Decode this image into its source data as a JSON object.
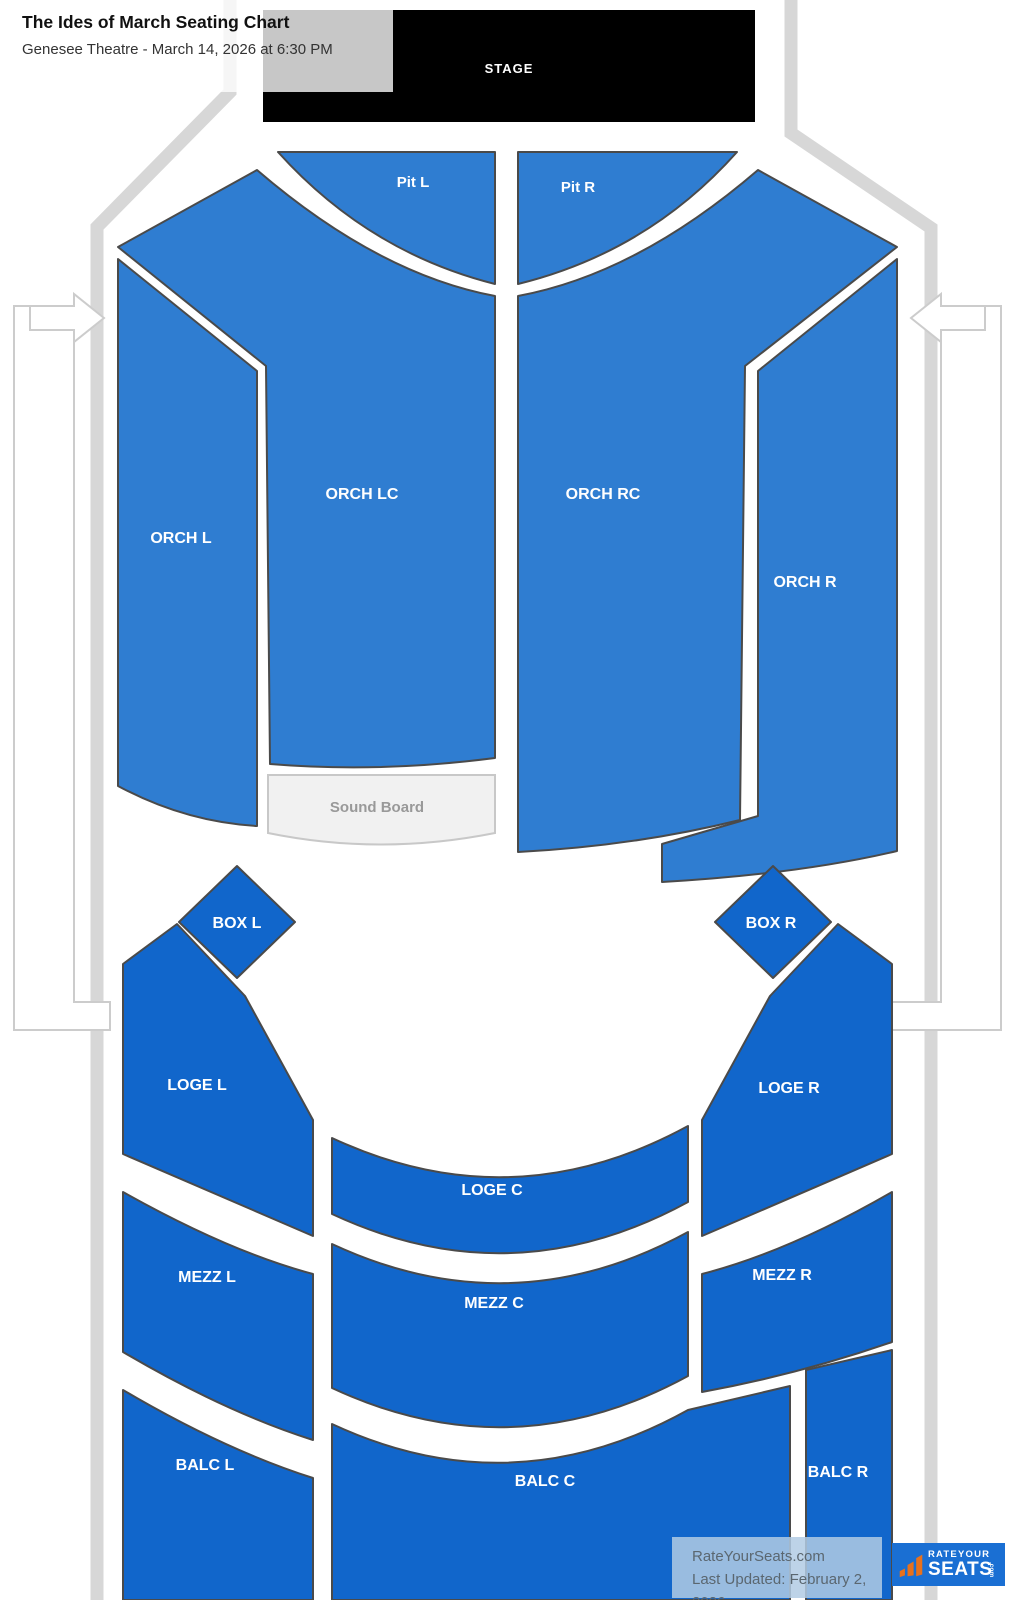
{
  "header": {
    "title": "The Ides of March Seating Chart",
    "subtitle": "Genesee Theatre - March 14, 2026 at 6:30 PM"
  },
  "stage": {
    "label": "STAGE"
  },
  "sections": {
    "pit_l": "Pit L",
    "pit_r": "Pit R",
    "orch_l": "ORCH L",
    "orch_lc": "ORCH LC",
    "orch_rc": "ORCH RC",
    "orch_r": "ORCH R",
    "sound_board": "Sound Board",
    "box_l": "BOX L",
    "box_r": "BOX R",
    "loge_l": "LOGE L",
    "loge_c": "LOGE C",
    "loge_r": "LOGE R",
    "mezz_l": "MEZZ L",
    "mezz_c": "MEZZ C",
    "mezz_r": "MEZZ R",
    "balc_l": "BALC L",
    "balc_c": "BALC C",
    "balc_r": "BALC R"
  },
  "icons": {
    "entry_arrow_left": "arrow-right-into-venue",
    "entry_arrow_right": "arrow-left-into-venue",
    "logo_bars": "rateyourseats-wing-bars"
  },
  "footer": {
    "site": "RateYourSeats.com",
    "last_updated": "Last Updated: February 2, 2026",
    "logo_top": "RATEYOUR",
    "logo_main": "SEATS",
    "logo_tld": ".com"
  },
  "colors": {
    "section_primary": "#2f7dd1",
    "section_secondary": "#1166cb",
    "section_border": "#4a4a4a",
    "stage_bg": "#000000",
    "stage_text": "#ffffff",
    "label_text": "#ffffff",
    "wall": "#d7d7d7",
    "corridor_border": "#cccccc",
    "soundboard_bg": "#f1f1f1",
    "soundboard_border": "#c8c8c8",
    "soundboard_text": "#999999",
    "title_text": "#111111",
    "subtitle_text": "#333333",
    "footer_text": "#5b6770",
    "logo_bg": "#1a6fd3",
    "logo_orange": "#e8711c"
  }
}
